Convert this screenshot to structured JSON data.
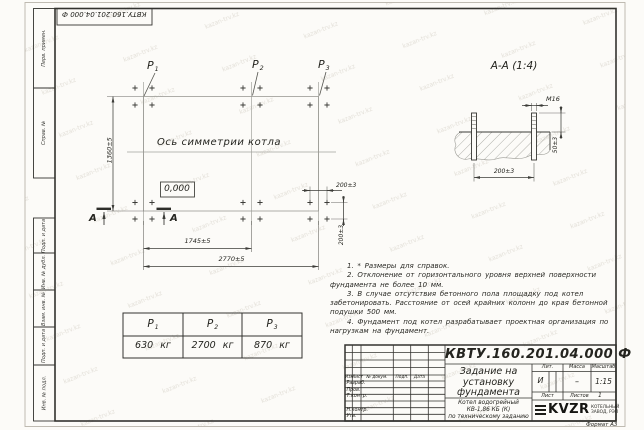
{
  "watermark": "kazan-trv.kz",
  "corner_stamp": "КВТУ.160.201.04.000 Ф",
  "margin_labels": {
    "perv_primen": "Перв. примен.",
    "sprav_no": "Справ. №",
    "podp_data_1": "Подп. и дата",
    "inv_dubl": "Инв. № дубл.",
    "vzam_inv": "Взам. инв. №",
    "podp_data_2": "Подп. и дата",
    "inv_podl": "Инв. № подл."
  },
  "plan": {
    "points": [
      {
        "label": "P",
        "sub": "1"
      },
      {
        "label": "P",
        "sub": "2"
      },
      {
        "label": "P",
        "sub": "3"
      }
    ],
    "axis_caption": "Ось симметрии котла",
    "elevation_mark": "0,000",
    "dim_height": "1360±5",
    "dim_span_1": "1745±5",
    "dim_span_2": "2770±5",
    "dim_bolt_x": "200±3",
    "dim_bolt_y": "200±3",
    "section_letter_left": "А",
    "section_letter_right": "А"
  },
  "section_view": {
    "title": "А-А (1:4)",
    "thread_label": "М16",
    "dim_protrusion": "50±3",
    "dim_spacing": "200±3"
  },
  "loads_table": {
    "columns": [
      {
        "head": "P",
        "sub": "1",
        "value": "630 кг"
      },
      {
        "head": "P",
        "sub": "2",
        "value": "2700 кг"
      },
      {
        "head": "P",
        "sub": "3",
        "value": "870 кг"
      }
    ]
  },
  "notes": [
    "1. * Размеры для справок.",
    "2. Отклонение от горизонтального уровня верхней поверхности фундамента не более 10 мм.",
    "3. В случае отсутствия бетонного пола площадку под котел забетонировать. Расстояние от осей крайних колонн до края бетонной подушки 500 мм.",
    "4. Фундамент под котел разрабатывает проектная организация по нагрузкам на фундамент."
  ],
  "title_block": {
    "doc_number": "КВТУ.160.201.04.000  Ф",
    "doc_title": "Задание на установку фундамента",
    "product_lines": [
      "Котел водогрейный",
      "КВ-1,86 КБ (К)",
      "по техническому заданию"
    ],
    "cols": {
      "izm": "Изм.",
      "list": "Лист",
      "doc_no": "№ докум.",
      "podp": "Подп.",
      "data": "Дата"
    },
    "rows": {
      "razrab": "Разраб.",
      "prov": "Пров.",
      "tkontr": "Т.контр.",
      "nkontr": "Н.контр.",
      "utv": "Утв."
    },
    "lit_label": "Лит.",
    "mass_label": "Масса",
    "scale_label": "Масштаб",
    "lit_value": "И",
    "mass_value": "–",
    "scale_value": "1:15",
    "sheet_label": "Лист",
    "sheets_label": "Листов",
    "sheets_value": "1",
    "logo_text": "KVZR",
    "logo_desc_lines": [
      "КОТЕЛЬНЫЙ",
      "ЗАВОД, РЭП"
    ]
  },
  "format_note": "Формат А3"
}
